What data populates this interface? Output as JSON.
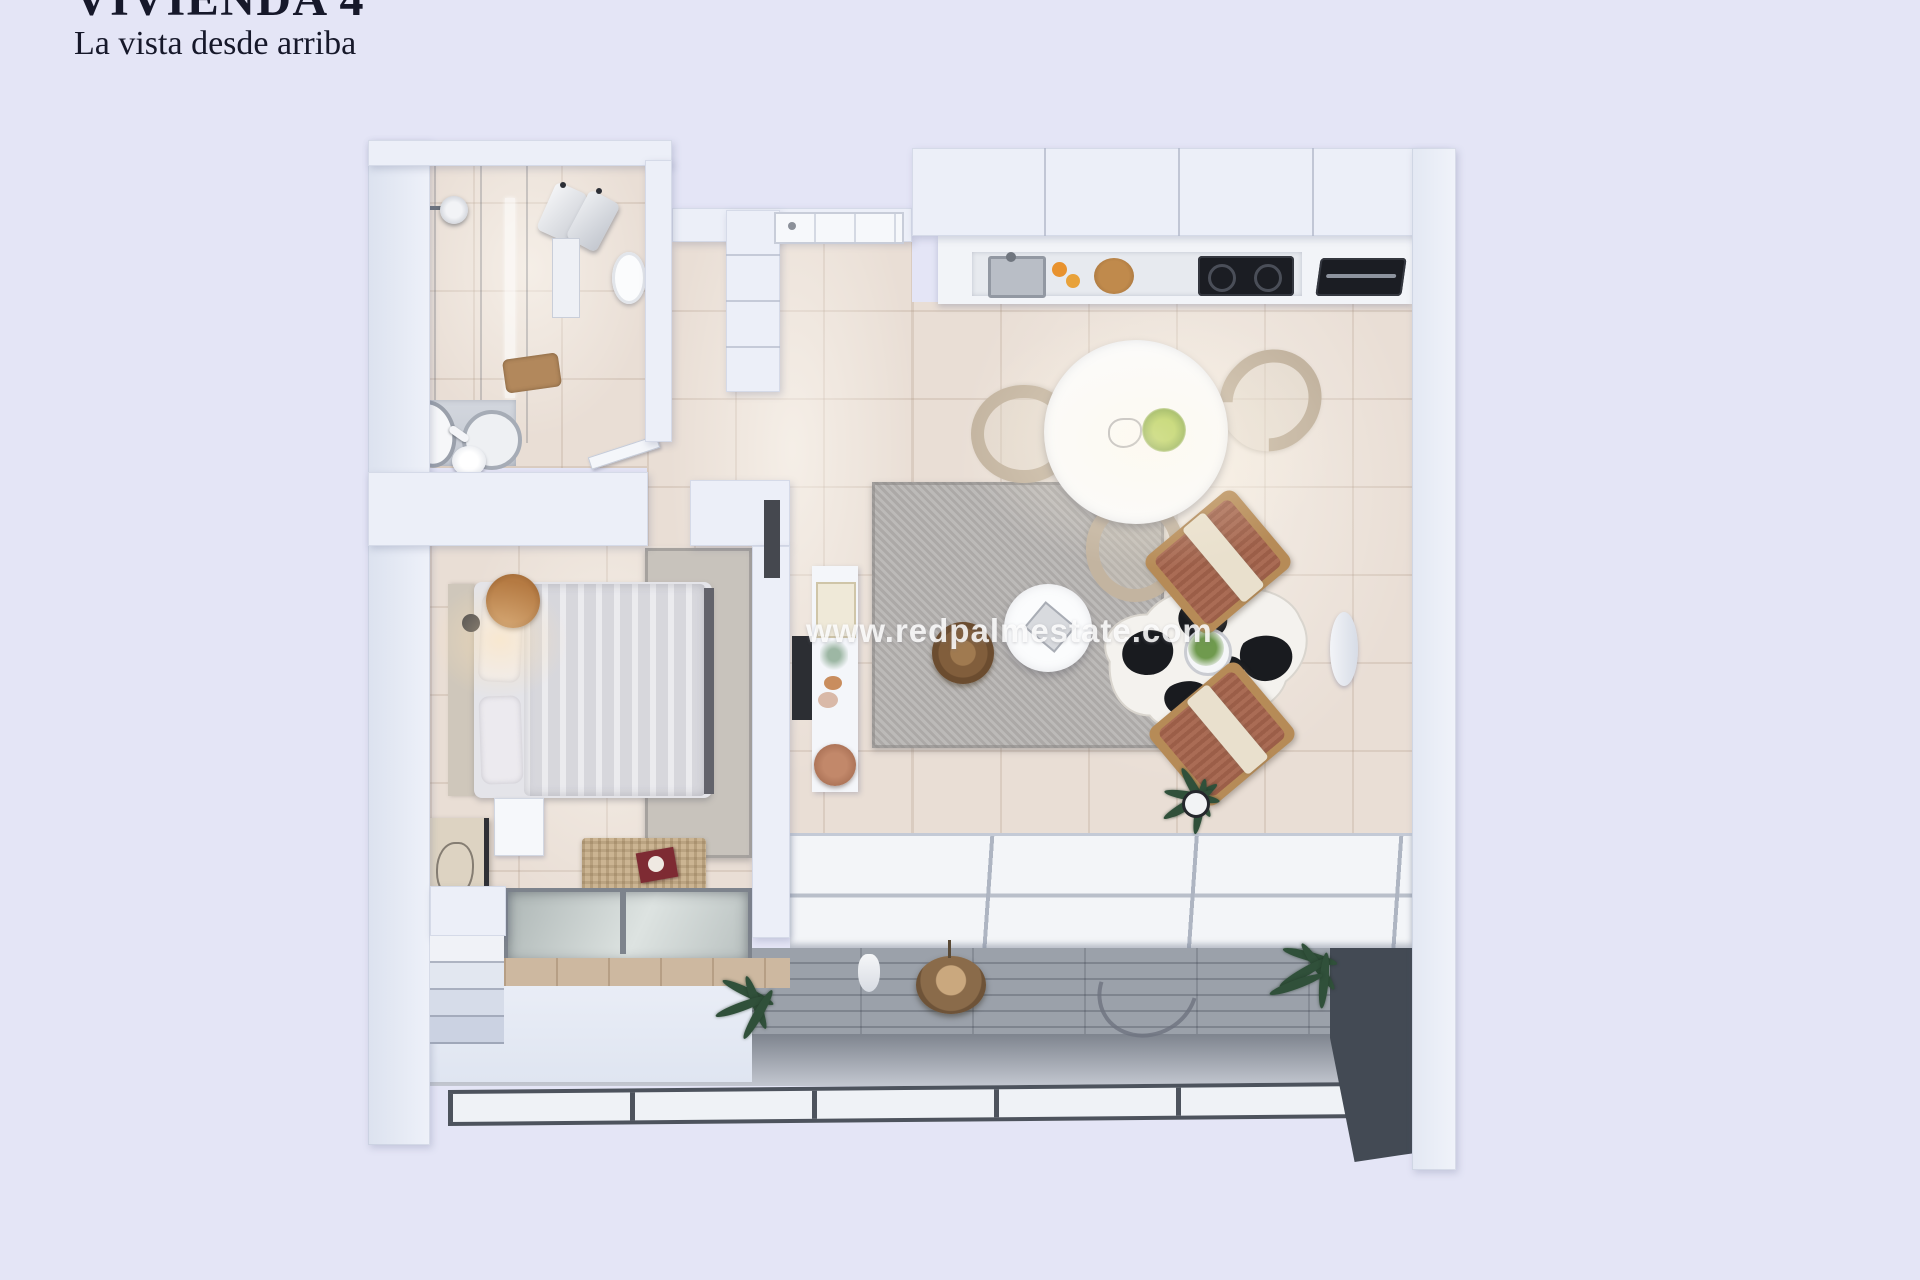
{
  "header": {
    "title": "VIVIENDA 4",
    "subtitle": "La vista desde arriba"
  },
  "watermark": {
    "text": "www.redpalmestate.com"
  },
  "palette": {
    "background": "#e4e5f6",
    "walls": "#eceff8",
    "floor_tile_beige": "#e9ded5",
    "shower_tile_gray": "#b6bac2",
    "rug_gray": "#b5b2b0",
    "sofa_cream": "#f0ead6",
    "armchair_terracotta": "#a5644c",
    "wood_brown": "#a9713e",
    "cowhide_black": "#191b1f",
    "dark_wall": "#434a54",
    "plant_green": "#87b641"
  }
}
